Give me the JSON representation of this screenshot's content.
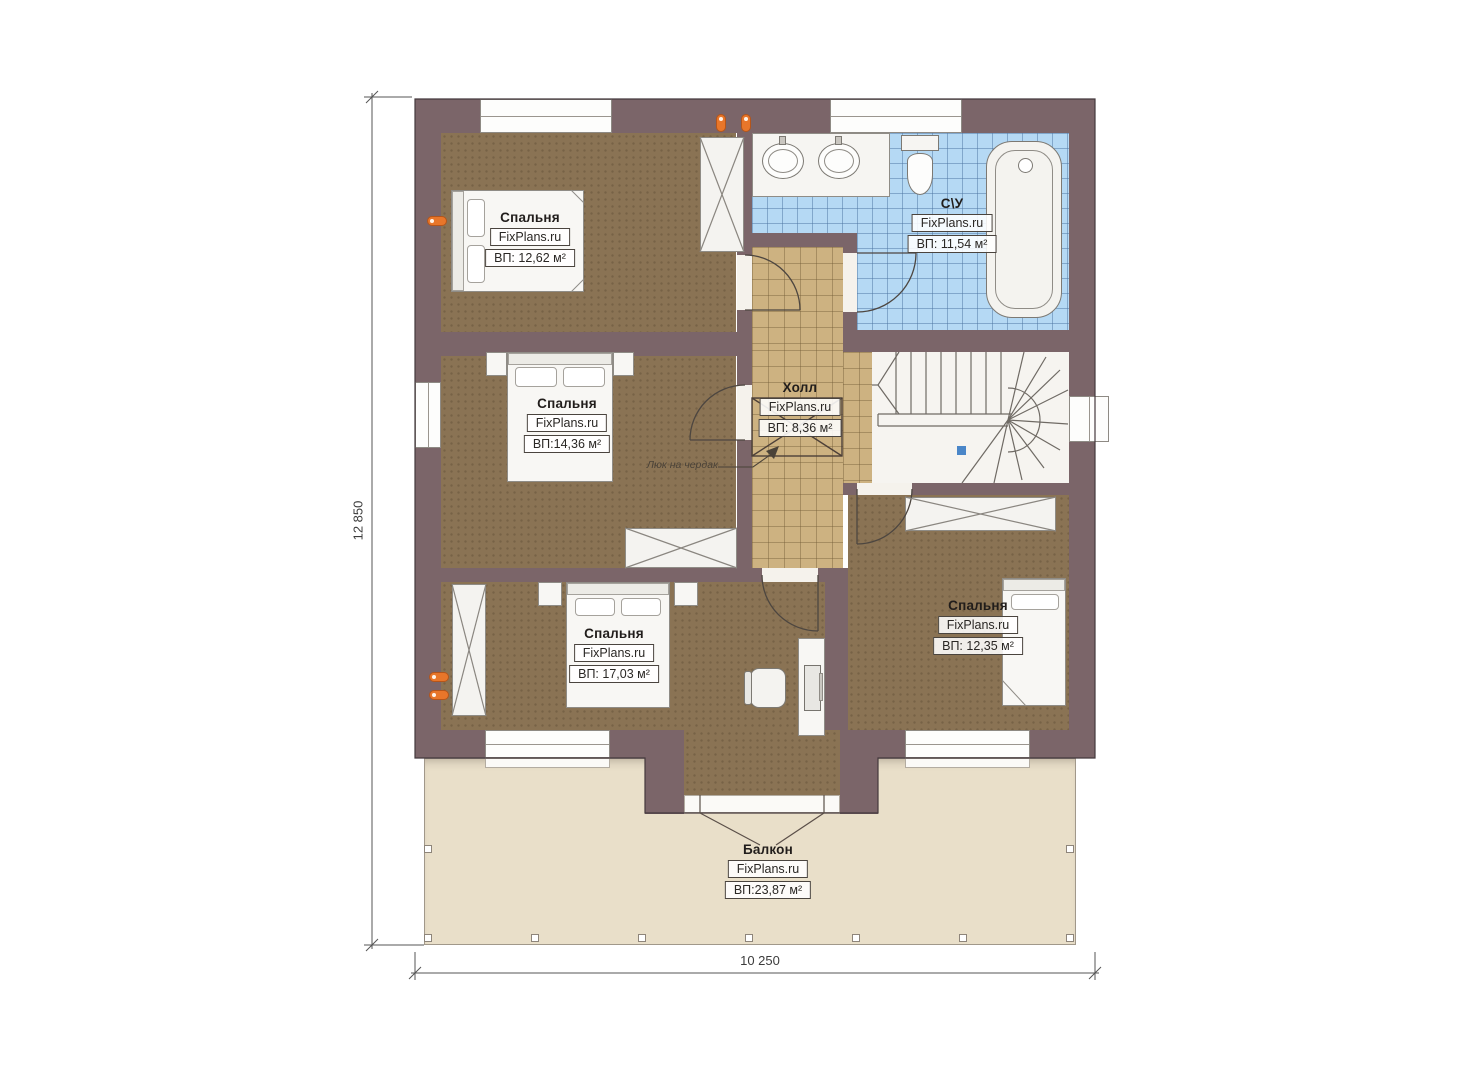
{
  "plan": {
    "rooms": [
      {
        "id": "bedroom-top-left",
        "name": "Спальня",
        "brand": "FixPlans.ru",
        "area": "ВП: 12,62 м²"
      },
      {
        "id": "bathroom",
        "name": "С\\У",
        "brand": "FixPlans.ru",
        "area": "ВП: 11,54 м²"
      },
      {
        "id": "bedroom-middle-left",
        "name": "Спальня",
        "brand": "FixPlans.ru",
        "area": "ВП:14,36 м²"
      },
      {
        "id": "hall",
        "name": "Холл",
        "brand": "FixPlans.ru",
        "area": "ВП: 8,36 м²"
      },
      {
        "id": "bedroom-bottom-center",
        "name": "Спальня",
        "brand": "FixPlans.ru",
        "area": "ВП: 17,03 м²"
      },
      {
        "id": "bedroom-bottom-right",
        "name": "Спальня",
        "brand": "FixPlans.ru",
        "area": "ВП: 12,35 м²"
      },
      {
        "id": "balcony",
        "name": "Балкон",
        "brand": "FixPlans.ru",
        "area": "ВП:23,87 м²"
      }
    ],
    "annotations": {
      "attic_hatch": "Люк на чердак"
    },
    "dimensions": {
      "height": "12 850",
      "width": "10 250"
    },
    "colors": {
      "wall": "#7b6569",
      "bedroom_floor": "#8a7354",
      "hall_floor": "#cdb281",
      "bath_floor": "#b5d9f4",
      "balcony_floor": "#e9dfc9",
      "marker_orange": "#e8762a",
      "stair_marker_blue": "#4a86c8"
    }
  }
}
